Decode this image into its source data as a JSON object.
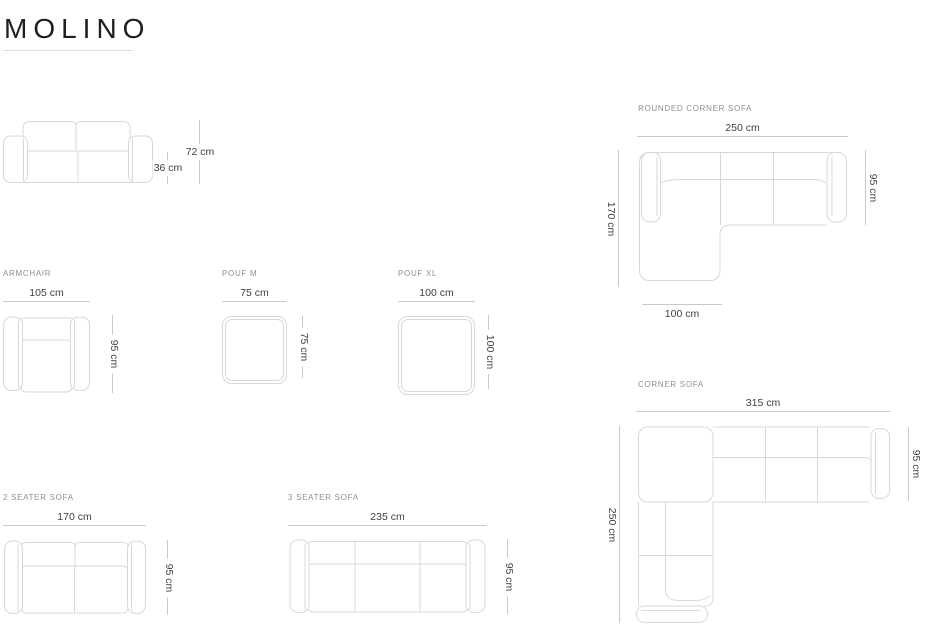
{
  "title": "MOLINO",
  "colors": {
    "title": "#1f1f1f",
    "section_label": "#8f8f8f",
    "dim_text": "#404040",
    "dim_line": "#c9c9c9",
    "drawing_line": "#d8d8d8",
    "underline": "#dedede"
  },
  "items": {
    "sofa_front": {
      "dims": {
        "height": "72 cm",
        "seat_height": "36 cm"
      }
    },
    "rounded_corner_sofa": {
      "label": "ROUNDED CORNER SOFA",
      "dims": {
        "width": "250 cm",
        "depth_total": "170 cm",
        "depth": "95 cm",
        "chaise_width": "100 cm"
      }
    },
    "armchair": {
      "label": "ARMCHAIR",
      "dims": {
        "width": "105 cm",
        "depth": "95 cm"
      }
    },
    "pouf_m": {
      "label": "POUF M",
      "dims": {
        "width": "75 cm",
        "depth": "75 cm"
      }
    },
    "pouf_xl": {
      "label": "POUF XL",
      "dims": {
        "width": "100 cm",
        "depth": "100 cm"
      }
    },
    "corner_sofa": {
      "label": "CORNER SOFA",
      "dims": {
        "width": "315 cm",
        "depth_total": "250 cm",
        "depth": "95 cm"
      }
    },
    "two_seater_sofa": {
      "label": "2 SEATER SOFA",
      "dims": {
        "width": "170 cm",
        "depth": "95 cm"
      }
    },
    "three_seater_sofa": {
      "label": "3 SEATER SOFA",
      "dims": {
        "width": "235 cm",
        "depth": "95 cm"
      }
    }
  }
}
